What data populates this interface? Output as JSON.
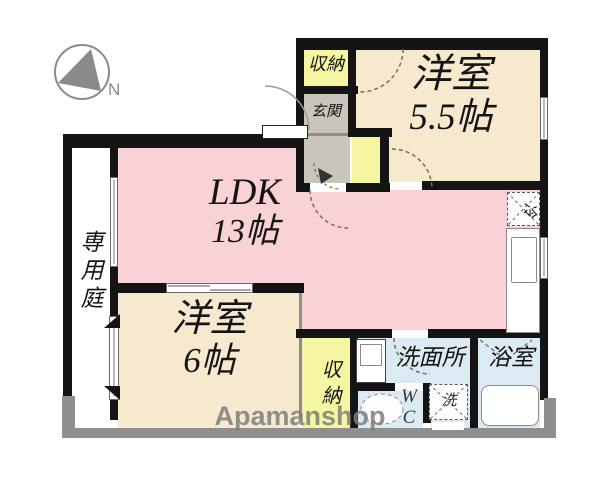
{
  "compass": {
    "label": "N"
  },
  "watermark": "Apamanshop",
  "rooms": {
    "ldk": {
      "name": "LDK",
      "size": "13帖"
    },
    "bedroom_55": {
      "name": "洋室",
      "size": "5.5帖"
    },
    "bedroom_6": {
      "name": "洋室",
      "size": "6帖"
    },
    "private_garden": {
      "name": "専用庭"
    },
    "entrance": {
      "name": "玄関"
    },
    "closet_top": {
      "name": "収納"
    },
    "closet_bottom": {
      "name": "収納"
    },
    "washroom": {
      "name": "洗面所"
    },
    "bathroom": {
      "name": "浴室"
    },
    "toilet": {
      "line1": "W",
      "line2": "C"
    },
    "washer": {
      "label": "洗"
    },
    "fridge": {
      "label": "冷"
    }
  },
  "colors": {
    "room_pink": "#f8d2d4",
    "room_beige": "#f6e9cd",
    "closet_yellow": "#f6f6a2",
    "entrance_gray": "#c9c5ba",
    "wet_area_blue": "#dcebf3",
    "wall_black": "#141414",
    "exterior_gray": "#8f8f8f",
    "watermark_gray": "#7d7d7d"
  }
}
